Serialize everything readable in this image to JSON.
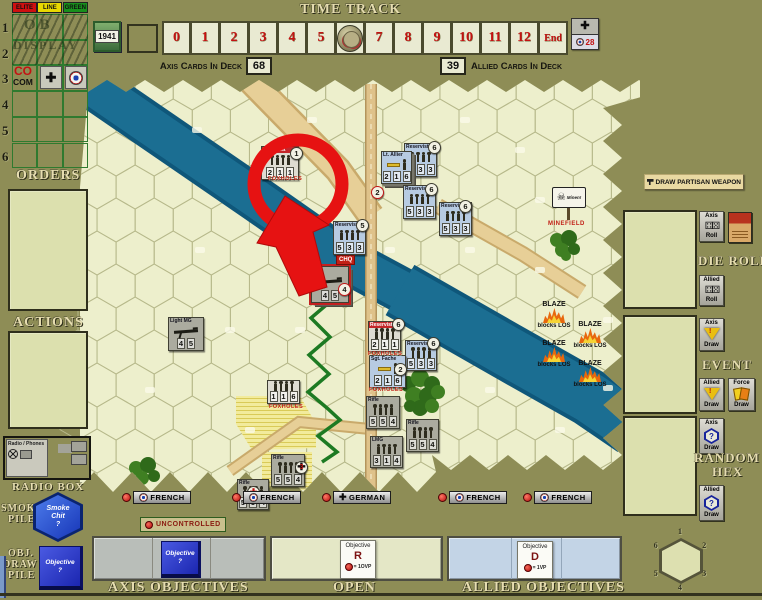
{
  "ob": {
    "columns": [
      {
        "label": "ELITE",
        "color": "#d01010"
      },
      {
        "label": "LINE",
        "color": "#e8d800"
      },
      {
        "label": "GREEN",
        "color": "#18901c"
      }
    ],
    "rows": [
      "1",
      "2",
      "3",
      "4",
      "5",
      "6"
    ],
    "watermark": [
      "OB",
      "DISPLAY"
    ],
    "co_top": "CO",
    "co_bottom": "COM",
    "year": "1941"
  },
  "time_track": {
    "title": "TIME TRACK",
    "cells": [
      "0",
      "1",
      "2",
      "3",
      "4",
      "5",
      "6",
      "7",
      "8",
      "9",
      "10",
      "11",
      "12",
      "End"
    ],
    "token_index": 6
  },
  "decks": {
    "axis_label": "Axis Cards In Deck",
    "axis_count": "68",
    "allied_count": "39",
    "allied_label": "Allied Cards In Deck",
    "vp_value": "28"
  },
  "left": {
    "orders": "ORDERS",
    "actions": "ACTIONS",
    "radio_box": "RADIO BOX",
    "radio_tile": "Radio / Phones",
    "smoke_pile": [
      "SMOKE",
      "PILE"
    ],
    "smoke_chit": [
      "Smoke",
      "Chit",
      "?"
    ],
    "obj_pile": [
      "OBJ.",
      "DRAW",
      "PILE"
    ],
    "obj_card": [
      "Objective",
      "?"
    ]
  },
  "right": {
    "partisan_button": "DRAW PARTISAN WEAPON",
    "die_roll_title": "DIE ROLL",
    "event_title": "EVENT",
    "random_hex_title": [
      "RANDOM",
      "HEX"
    ],
    "buttons": {
      "axis_roll": [
        "Axis",
        "Roll"
      ],
      "allied_roll": [
        "Allied",
        "Roll"
      ],
      "axis_event": [
        "Axis",
        "Draw"
      ],
      "allied_event": [
        "Allied",
        "Draw"
      ],
      "force_draw": [
        "Force",
        "Draw"
      ],
      "axis_hex": [
        "Axis",
        "Draw"
      ],
      "allied_hex": [
        "Allied",
        "Draw"
      ]
    },
    "compass": [
      "1",
      "2",
      "3",
      "4",
      "5",
      "6"
    ]
  },
  "map": {
    "units": [
      {
        "x": 261,
        "y": 146,
        "w": 38,
        "h": 34,
        "side": "white",
        "name": "Reservist",
        "icon": "figs",
        "values": [
          "2",
          "1",
          "1"
        ]
      },
      {
        "x": 404,
        "y": 143,
        "w": 33,
        "h": 34,
        "side": "french",
        "name": "Reservist",
        "icon": "figs",
        "values": [
          "5",
          "3",
          "3"
        ]
      },
      {
        "x": 381,
        "y": 151,
        "w": 31,
        "h": 33,
        "side": "french",
        "name": "Lt. Allier",
        "icon": "leader",
        "values": [
          "2",
          "1",
          "6"
        ],
        "stack": true
      },
      {
        "x": 403,
        "y": 185,
        "w": 33,
        "h": 34,
        "side": "french",
        "name": "Reservist",
        "icon": "figs",
        "values": [
          "5",
          "3",
          "3"
        ]
      },
      {
        "x": 439,
        "y": 202,
        "w": 33,
        "h": 34,
        "side": "french",
        "name": "Reservist",
        "icon": "figs",
        "values": [
          "5",
          "3",
          "3"
        ]
      },
      {
        "x": 333,
        "y": 221,
        "w": 33,
        "h": 34,
        "side": "french",
        "name": "Reservist",
        "icon": "figs",
        "values": [
          "5",
          "3",
          "3"
        ]
      },
      {
        "x": 311,
        "y": 266,
        "w": 38,
        "h": 37,
        "side": "german",
        "name": "MG",
        "icon": "gun",
        "values": [
          "4",
          "5"
        ],
        "stack": true,
        "sel": true
      },
      {
        "x": 168,
        "y": 317,
        "w": 36,
        "h": 34,
        "side": "german",
        "name": "Light MG",
        "icon": "gun",
        "values": [
          "4",
          "5"
        ]
      },
      {
        "x": 368,
        "y": 321,
        "w": 33,
        "h": 31,
        "side": "white",
        "name": "Reservist",
        "icon": "figs",
        "values": [
          "2",
          "1",
          "1"
        ]
      },
      {
        "x": 405,
        "y": 340,
        "w": 32,
        "h": 31,
        "side": "french",
        "name": "Reservist",
        "icon": "figs",
        "values": [
          "5",
          "3",
          "3"
        ]
      },
      {
        "x": 369,
        "y": 355,
        "w": 37,
        "h": 33,
        "side": "french",
        "name": "Sgt. Fache",
        "icon": "leader",
        "values": [
          "2",
          "1",
          "6"
        ]
      },
      {
        "x": 267,
        "y": 380,
        "w": 33,
        "h": 24,
        "side": "white",
        "icon": "figs",
        "values": [
          "1",
          "1",
          "6"
        ]
      },
      {
        "x": 366,
        "y": 396,
        "w": 34,
        "h": 33,
        "side": "german",
        "name": "Rifle",
        "icon": "figs",
        "values": [
          "5",
          "5",
          "4"
        ]
      },
      {
        "x": 406,
        "y": 419,
        "w": 33,
        "h": 33,
        "side": "german",
        "name": "Rifle",
        "icon": "figs",
        "values": [
          "5",
          "5",
          "4"
        ]
      },
      {
        "x": 370,
        "y": 436,
        "w": 33,
        "h": 32,
        "side": "german",
        "name": "LMG",
        "icon": "figs",
        "values": [
          "3",
          "1",
          "4"
        ]
      },
      {
        "x": 271,
        "y": 454,
        "w": 34,
        "h": 33,
        "side": "german",
        "name": "Rifle",
        "icon": "figs",
        "values": [
          "5",
          "5",
          "4"
        ]
      },
      {
        "x": 237,
        "y": 479,
        "w": 32,
        "h": 31,
        "side": "german",
        "name": "Rifle",
        "icon": "figs",
        "values": [
          "5",
          "5",
          "4"
        ]
      }
    ],
    "discs": [
      {
        "x": 290,
        "y": 147,
        "t": "1",
        "s": "plain"
      },
      {
        "x": 371,
        "y": 186,
        "t": "2",
        "s": "red"
      },
      {
        "x": 428,
        "y": 141,
        "t": "6",
        "s": "plain"
      },
      {
        "x": 425,
        "y": 183,
        "t": "6",
        "s": "plain"
      },
      {
        "x": 459,
        "y": 200,
        "t": "6",
        "s": "plain"
      },
      {
        "x": 356,
        "y": 219,
        "t": "5",
        "s": "plain"
      },
      {
        "x": 338,
        "y": 283,
        "t": "4",
        "s": "red"
      },
      {
        "x": 392,
        "y": 318,
        "t": "6",
        "s": "plain"
      },
      {
        "x": 427,
        "y": 337,
        "t": "6",
        "s": "plain"
      },
      {
        "x": 394,
        "y": 363,
        "t": "2",
        "s": "plain"
      },
      {
        "x": 295,
        "y": 461,
        "t": "3",
        "s": "cross"
      },
      {
        "x": 247,
        "y": 486,
        "t": "",
        "s": "medic"
      }
    ],
    "foxholes_text": "FOXHOLES",
    "foxhole_labels": [
      {
        "x": 268,
        "y": 176
      },
      {
        "x": 368,
        "y": 351
      },
      {
        "x": 369,
        "y": 387
      },
      {
        "x": 269,
        "y": 404
      }
    ],
    "chq": {
      "x": 336,
      "y": 255,
      "text": "CHQ"
    },
    "minefield": {
      "x": 552,
      "y": 187,
      "sign": "Minen!",
      "label": "MINEFIELD"
    },
    "blaze": {
      "title": "BLAZE",
      "subtitle": "blocks LOS",
      "positions": [
        {
          "x": 534,
          "y": 301
        },
        {
          "x": 570,
          "y": 321
        },
        {
          "x": 534,
          "y": 340
        },
        {
          "x": 570,
          "y": 360
        }
      ]
    },
    "bars_y": 491,
    "bars": [
      {
        "x": 122,
        "label": "FRENCH",
        "icon": "roundel"
      },
      {
        "x": 232,
        "label": "FRENCH",
        "icon": "roundel"
      },
      {
        "x": 322,
        "label": "GERMAN",
        "icon": "cross"
      },
      {
        "x": 438,
        "label": "FRENCH",
        "icon": "roundel"
      },
      {
        "x": 523,
        "label": "FRENCH",
        "icon": "roundel"
      }
    ],
    "uncontrolled": "UNCONTROLLED"
  },
  "bottom": {
    "axis_title": "AXIS OBJECTIVES",
    "open_title": "OPEN",
    "allied_title": "ALLIED OBJECTIVES",
    "axis_card": [
      "Objective",
      "?"
    ],
    "open_card": {
      "l1": "Objective",
      "l2": "R",
      "l3": "= 1OVP"
    },
    "allied_card": {
      "l1": "Objective",
      "l2": "D",
      "l3": "= 1VP"
    }
  }
}
